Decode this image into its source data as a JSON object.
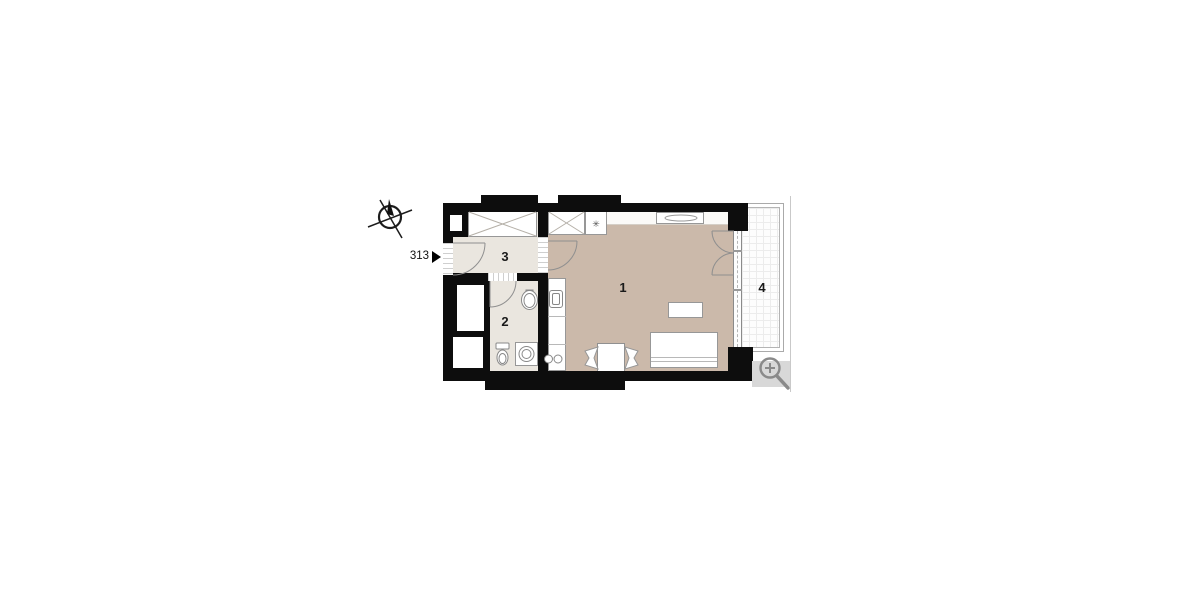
{
  "plan": {
    "unit_label": "313",
    "rooms": [
      {
        "id": "room-1",
        "label": "1"
      },
      {
        "id": "room-2",
        "label": "2"
      },
      {
        "id": "room-3",
        "label": "3"
      },
      {
        "id": "room-4",
        "label": "4"
      }
    ],
    "symbols": {
      "fridge_star": "✳"
    },
    "icons": {
      "compass": "north-indicator-icon",
      "entrance_marker": "entrance-triangle-icon",
      "zoom": "zoom-in-icon"
    },
    "colors": {
      "wall": "#0d0d0d",
      "room_main_floor": "#cbb9aa",
      "room_service_floor": "#eae6df",
      "balcony_grid": "#ececec",
      "furniture_outline": "#979797",
      "ui_gray": "#8a8a8a"
    }
  }
}
